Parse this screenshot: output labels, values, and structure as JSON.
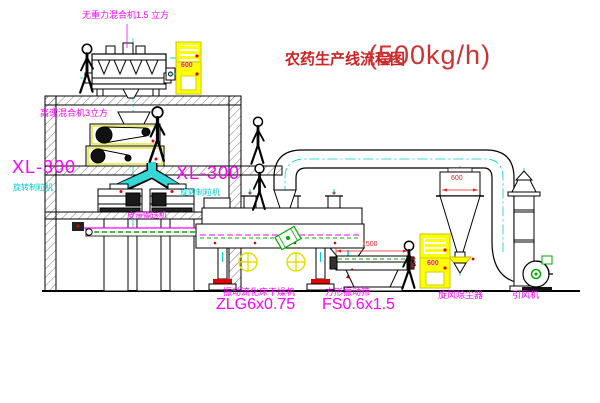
{
  "title": {
    "text": "农药生产线流程图",
    "capacity": "(500kg/h)"
  },
  "labels": {
    "gravity_mixer": "无重力混合机1.5 立方",
    "high_speed_mixer": "高速混合机3立方",
    "granulator_left_model": "XL-300",
    "granulator_left_name": "旋转制粒机",
    "granulator_right_model": "XL-300",
    "granulator_right_name": "旋转制粒机",
    "belt_conveyor": "皮带输送机",
    "dryer_name": "振动流化床干燥机",
    "dryer_model": "ZLG6x0.75",
    "screen_name": "方形振动筛",
    "screen_model": "FS0.6x1.5",
    "cyclone": "旋风除尘器",
    "fan": "引风机"
  },
  "dimensions": {
    "screen_length": "1500",
    "cyclone_inlet": "600",
    "screen_height": "350"
  },
  "cabinets": {
    "cabinet_top_text": "600",
    "cabinet_right_text": "600"
  },
  "colors": {
    "label_magenta": "#FF00FF",
    "centerline_cyan": "#00D2D2",
    "duct_cyan_fill": "#35D6D6",
    "dimension_red": "#DD2222",
    "cabinet_yellow": "#FFFF00",
    "machine_green": "#00AA00",
    "line_black": "#000000",
    "background": "#FFFFFF"
  }
}
